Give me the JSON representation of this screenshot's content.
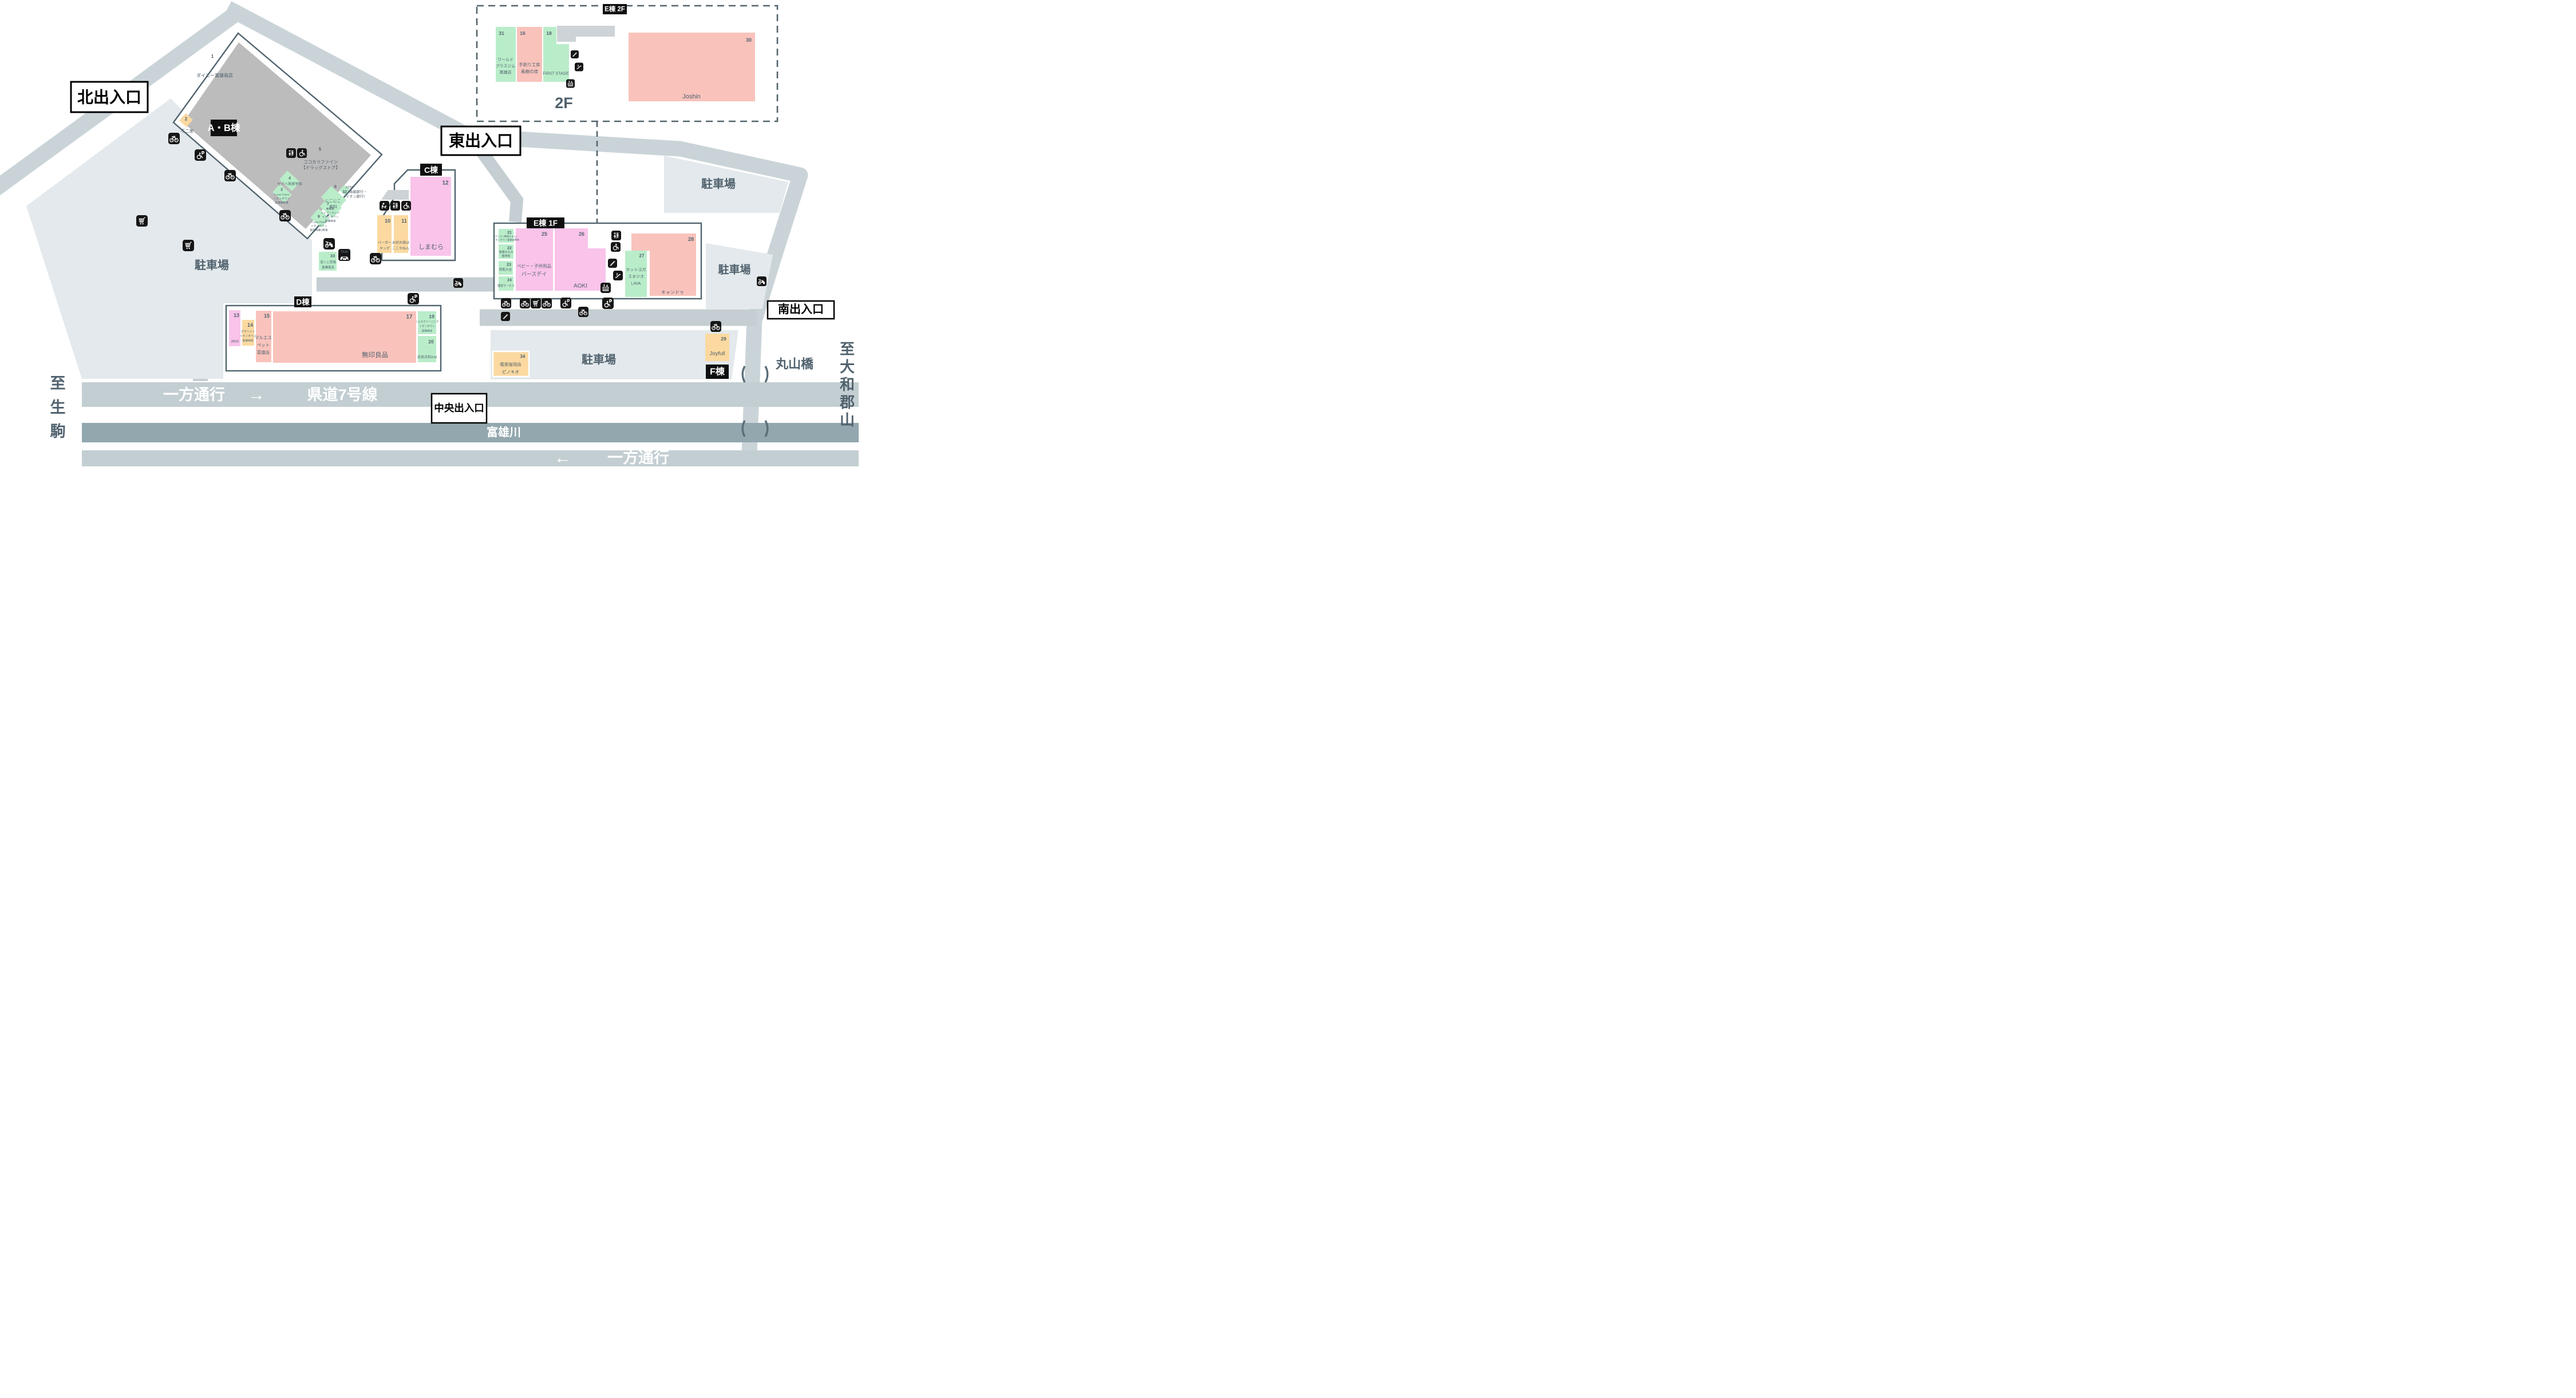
{
  "colors": {
    "green": "#b9edc9",
    "salmon": "#f9c3bc",
    "pink": "#f9c3ea",
    "yellow": "#fbd9a0",
    "building_gray": "#bcbcbc",
    "road": "#cad4d8",
    "road_band": "#c3ced2",
    "river": "#93a7af",
    "parking": "#e3e9ec",
    "outline": "#51646e",
    "label_black": "#0f0f0f"
  },
  "labels": {
    "ab": "A・B棟",
    "c": "C棟",
    "d": "D棟",
    "e1f": "E棟 1F",
    "e2f": "E棟 2F",
    "f": "F棟",
    "floor2": "2F",
    "north": "北出入口",
    "east": "東出入口",
    "central": "中央出入口",
    "south": "南出入口",
    "one_way": "一方通行",
    "route7": "県道7号線",
    "arrow_right": "→",
    "arrow_left": "←",
    "river": "富雄川",
    "bridge": "丸山橋",
    "parking": "駐車場",
    "taxi": "TAXI",
    "to_ikoma": [
      "至",
      "生",
      "駒"
    ],
    "to_koriyama": [
      "至",
      "大",
      "和",
      "郡",
      "山"
    ]
  },
  "shops": {
    "n1": {
      "num": "1",
      "lines": [
        "ダイエー富雄南店"
      ]
    },
    "n2": {
      "num": "2",
      "lines": [
        "不二家"
      ]
    },
    "n3": {
      "num": "3",
      "lines": [
        "I Love Piano",
        "イオンタウン",
        "富雄南教室"
      ]
    },
    "n4": {
      "num": "4",
      "lines": [
        "セイハ英語学院"
      ]
    },
    "n5": {
      "num": "5",
      "lines": [
        "ココカラファイン",
        "【ドラッグストア】"
      ]
    },
    "n6": {
      "num": "6",
      "lines": [
        "I Love Piano",
        "イオンタウン",
        "富雄南第2教室"
      ]
    },
    "n7": {
      "num": "7",
      "lines": [
        "美容室",
        "イレブンカット",
        "イオンタウン",
        "富雄南店"
      ]
    },
    "n8": {
      "num": "8",
      "lines": [
        "にこにこ",
        "歯科"
      ]
    },
    "n10": {
      "num": "10",
      "lines": [
        "バーガー",
        "キング"
      ]
    },
    "n11": {
      "num": "11",
      "lines": [
        "お好み焼は",
        "ここやねん"
      ]
    },
    "n12": {
      "num": "12",
      "lines": [
        "しまむら"
      ]
    },
    "n13": {
      "num": "13",
      "lines": [
        "JINS"
      ]
    },
    "n14": {
      "num": "14",
      "lines": [
        "ピザハット",
        "イオンタウン",
        "富雄南店"
      ]
    },
    "n15": {
      "num": "15",
      "lines": [
        "マルエス",
        "ペット",
        "富雄店"
      ]
    },
    "n16": {
      "num": "16",
      "lines": [
        "手創り工房",
        "風樹の塔"
      ]
    },
    "n17": {
      "num": "17",
      "lines": [
        "無印良品"
      ]
    },
    "n18": {
      "num": "18",
      "lines": [
        "FIRST STAGE"
      ]
    },
    "n19": {
      "num": "19",
      "lines": [
        "ノムラクリーニング",
        "イオンタウン",
        "富雄南店"
      ]
    },
    "n20": {
      "num": "20",
      "lines": [
        "奈良日和2nd"
      ]
    },
    "n21": {
      "num": "21",
      "lines": [
        "パソコン教室かるん♪",
        "イオンタウン富雄南教室"
      ]
    },
    "n22": {
      "num": "22",
      "lines": [
        "富雄みなみ",
        "整骨院"
      ]
    },
    "n23": {
      "num": "23",
      "lines": [
        "買取大吉"
      ]
    },
    "n24": {
      "num": "24",
      "lines": [
        "理容サービス"
      ]
    },
    "n25": {
      "num": "25",
      "lines": [
        "ベビー・子供用品",
        "バースデイ"
      ]
    },
    "n26": {
      "num": "26",
      "lines": [
        "AOKI"
      ]
    },
    "n27": {
      "num": "27",
      "lines": [
        "ホットヨガ",
        "スタジオ",
        "LAVA"
      ]
    },
    "n28": {
      "num": "28",
      "lines": [
        "キャンドゥ"
      ]
    },
    "n29": {
      "num": "29",
      "lines": [
        "Joyfull"
      ]
    },
    "n30": {
      "num": "30",
      "lines": [
        "Joshin"
      ]
    },
    "n31": {
      "num": "31",
      "lines": [
        "ワールド",
        "プラスジム",
        "富雄店"
      ]
    },
    "n32": {
      "num": "32",
      "lines": [
        "ATM",
        "（南都銀行・",
        "イオン銀行）"
      ]
    },
    "n33": {
      "num": "33",
      "lines": [
        "宝くじ売場",
        "富雄南店"
      ]
    },
    "n34": {
      "num": "34",
      "lines": [
        "喫茶珈琲店",
        "ピノキオ"
      ]
    }
  }
}
